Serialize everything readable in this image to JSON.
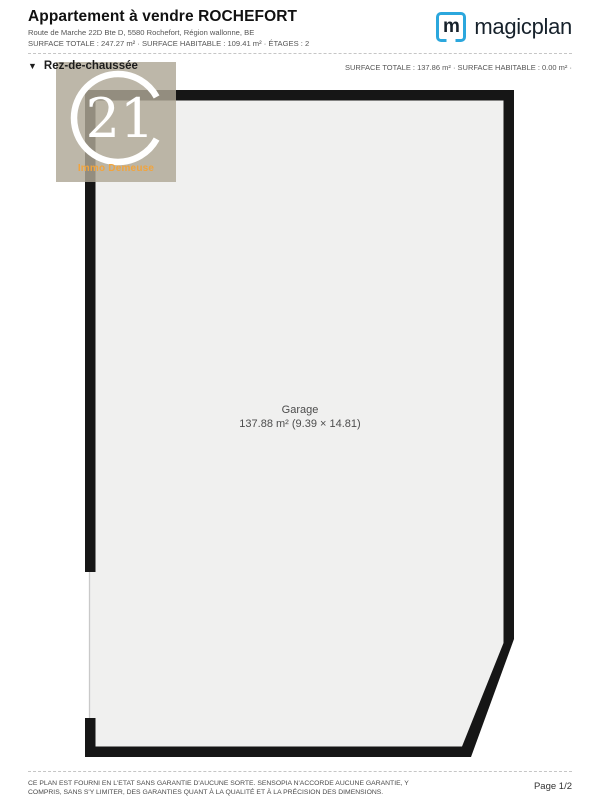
{
  "header": {
    "title": "Appartement à vendre ROCHEFORT",
    "address": "Route de Marche 22D Bte D, 5580 Rochefort, Région wallonne, BE",
    "surface_line": "SURFACE TOTALE : 247.27 m² · SURFACE HABITABLE : 109.41 m² · ÉTAGES : 2",
    "logo": {
      "icon_letter": "m",
      "brand": "magicplan",
      "brand_blue": "#2BA7DD"
    }
  },
  "floor_section": {
    "collapse_icon": "▼",
    "name": "Rez-de-chaussée",
    "stats": "SURFACE TOTALE : 137.86 m² · SURFACE HABITABLE : 0.00 m² ·"
  },
  "plan": {
    "room_name": "Garage",
    "room_dims": "137.88 m² (9.39 × 14.81)",
    "wall_color": "#161616",
    "floor_color": "#F0F0EF"
  },
  "watermark": {
    "seal_number": "21",
    "agency": "Immo Demeuse",
    "background": "#AFA796",
    "accent": "#F2A43C"
  },
  "footer": {
    "disclaimer_line1": "CE PLAN EST FOURNI EN L'ETAT SANS GARANTIE D'AUCUNE SORTE. SENSOPIA N'ACCORDE AUCUNE GARANTIE, Y",
    "disclaimer_line2": "COMPRIS, SANS S'Y LIMITER, DES GARANTIES QUANT À LA QUALITÉ ET À LA PRÉCISION DES DIMENSIONS.",
    "page": "Page 1/2"
  }
}
